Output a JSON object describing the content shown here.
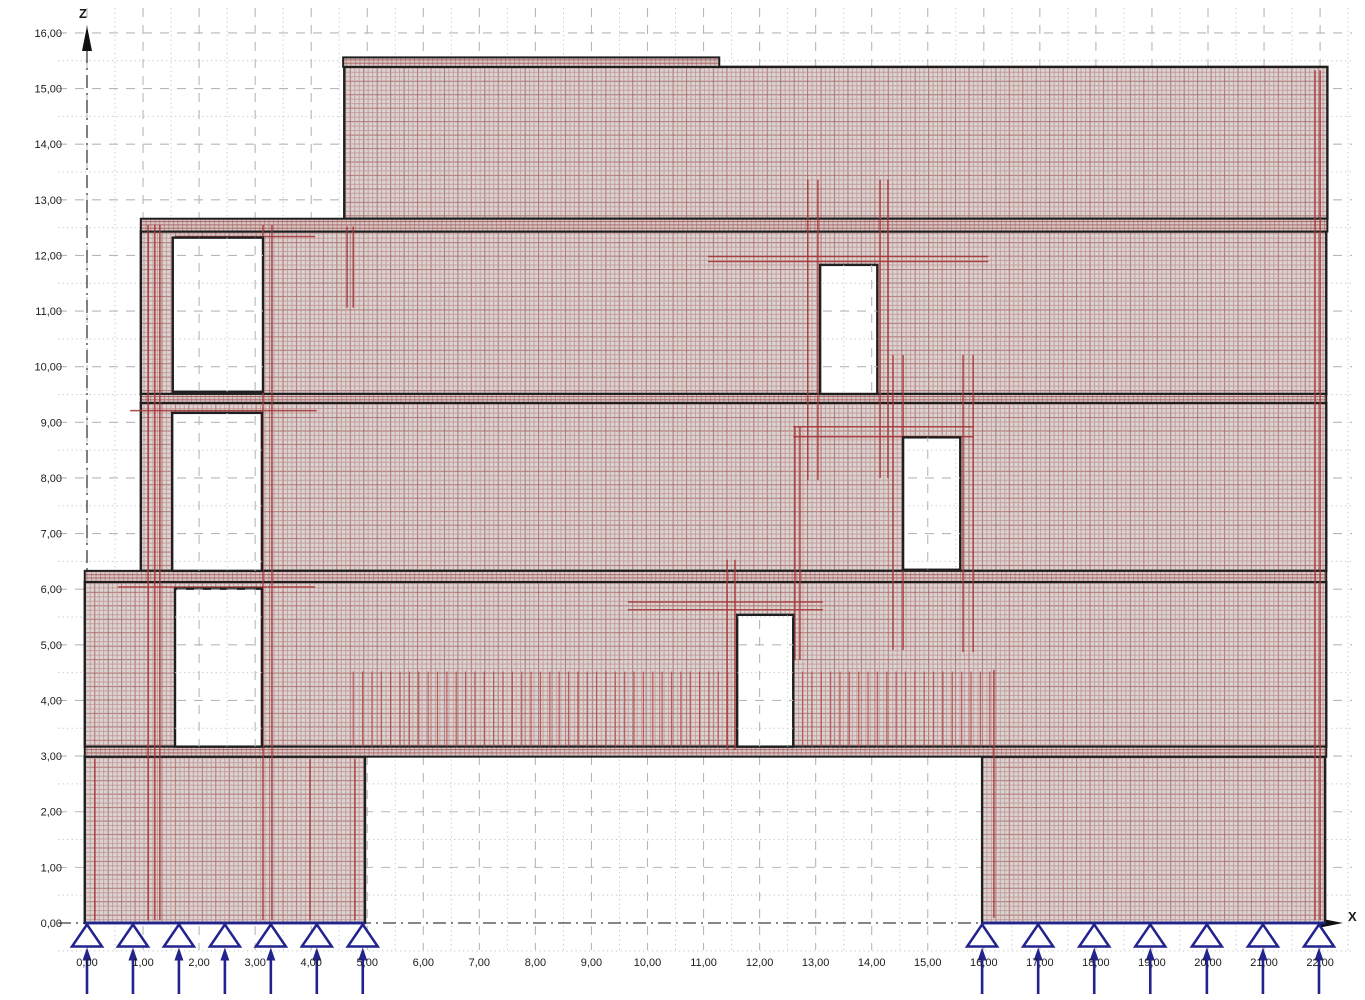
{
  "canvas": {
    "width": 1365,
    "height": 1000,
    "background": "#ffffff"
  },
  "scale": {
    "origin_px": {
      "x": 87,
      "y": 923
    },
    "px_per_m_x": 56.05,
    "px_per_m_y": 55.63
  },
  "axes": {
    "z": {
      "label": "Z",
      "tick_values": [
        16,
        15,
        14,
        13,
        12,
        11,
        10,
        9,
        8,
        7,
        6,
        5,
        4,
        3,
        2,
        1,
        0
      ],
      "tick_labels": [
        "16,00",
        "15,00",
        "14,00",
        "13,00",
        "12,00",
        "11,00",
        "10,00",
        "9,00",
        "8,00",
        "7,00",
        "6,00",
        "5,00",
        "4,00",
        "3,00",
        "2,00",
        "1,00",
        "0,00"
      ]
    },
    "x": {
      "label": "X",
      "tick_values": [
        0,
        1,
        2,
        3,
        4,
        5,
        6,
        7,
        8,
        9,
        10,
        11,
        12,
        13,
        14,
        15,
        16,
        17,
        18,
        19,
        20,
        21,
        22
      ],
      "tick_labels": [
        "0,00",
        "1,00",
        "2,00",
        "3,00",
        "4,00",
        "5,00",
        "6,00",
        "7,00",
        "8,00",
        "9,00",
        "10,00",
        "11,00",
        "12,00",
        "13,00",
        "14,00",
        "15,00",
        "16,00",
        "17,00",
        "18,00",
        "19,00",
        "20,00",
        "21,00",
        "22,00"
      ]
    }
  },
  "grid": {
    "x_major": [
      0,
      1,
      2,
      3,
      4,
      5,
      6,
      7,
      8,
      9,
      10,
      11,
      12,
      13,
      14,
      15,
      16,
      17,
      18,
      19,
      20,
      21,
      22
    ],
    "x_minor": [
      0.5,
      1.5,
      2.5,
      3.5,
      4.5,
      5.5,
      6.5,
      7.5,
      8.5,
      9.5,
      10.5,
      11.5,
      12.5,
      13.5,
      14.5,
      15.5,
      16.5,
      17.5,
      18.5,
      19.5,
      20.5,
      21.5,
      22.5
    ],
    "z_major": [
      1,
      2,
      3,
      4,
      5,
      6,
      7,
      8,
      9,
      10,
      11,
      12,
      13,
      14,
      15,
      16
    ],
    "z_minor": [
      -0.5,
      0.5,
      1.5,
      2.5,
      3.5,
      4.5,
      5.5,
      6.5,
      7.5,
      8.5,
      9.5,
      10.5,
      11.5,
      12.5,
      13.5,
      14.5,
      15.5
    ]
  },
  "colors": {
    "grid_major": "#b7b7b7",
    "grid_minor": "#c8c8c8",
    "axis_line": "#3d3d3d",
    "label_text": "#1a1a1a",
    "outline": "#1f1f1f",
    "wall_base": "#d8d5d3",
    "wall_mesh_light": "#c4908f",
    "wall_mesh_strong": "#ad6a68",
    "slab_base": "#d5c9c7",
    "slab_mesh_v": "#bd8181",
    "slab_mesh_h": "#a85c5c",
    "red_line": "#a63838",
    "comb_line": "#b24444",
    "support": "#23238e",
    "opening_fill": "#ffffff"
  },
  "structure": {
    "walls": [
      {
        "id": "ground-wall-left",
        "x0": -0.04,
        "x1": 4.96,
        "z0": 0.0,
        "z1": 2.99
      },
      {
        "id": "ground-wall-right",
        "x0": 15.97,
        "x1": 22.09,
        "z0": 0.0,
        "z1": 2.99
      },
      {
        "id": "story1-wall",
        "x0": -0.04,
        "x1": 22.11,
        "z0": 3.17,
        "z1": 6.13
      },
      {
        "id": "story2-wall",
        "x0": 0.96,
        "x1": 22.11,
        "z0": 6.33,
        "z1": 9.35
      },
      {
        "id": "story3-wall",
        "x0": 0.96,
        "x1": 22.11,
        "z0": 9.51,
        "z1": 12.43
      },
      {
        "id": "top-wall",
        "x0": 4.59,
        "x1": 22.13,
        "z0": 12.66,
        "z1": 15.39
      }
    ],
    "slabs": [
      {
        "id": "slab-level1",
        "x0": -0.04,
        "x1": 22.11,
        "z0": 2.99,
        "z1": 3.17
      },
      {
        "id": "slab-level2",
        "x0": -0.04,
        "x1": 22.11,
        "z0": 6.13,
        "z1": 6.33
      },
      {
        "id": "slab-level3",
        "x0": 0.96,
        "x1": 22.11,
        "z0": 9.35,
        "z1": 9.51
      },
      {
        "id": "slab-level4",
        "x0": 0.96,
        "x1": 22.13,
        "z0": 12.43,
        "z1": 12.66
      },
      {
        "id": "roof-parapet",
        "x0": 4.57,
        "x1": 11.28,
        "z0": 15.39,
        "z1": 15.56
      }
    ],
    "openings": [
      {
        "id": "opening-upper-left",
        "x0": 1.53,
        "x1": 3.14,
        "z0": 9.55,
        "z1": 12.32
      },
      {
        "id": "opening-mid-left",
        "x0": 1.52,
        "x1": 3.12,
        "z0": 6.33,
        "z1": 9.17
      },
      {
        "id": "opening-lower-left",
        "x0": 1.57,
        "x1": 3.12,
        "z0": 3.17,
        "z1": 6.01
      },
      {
        "id": "opening-lower-mid",
        "x0": 11.6,
        "x1": 12.6,
        "z0": 3.17,
        "z1": 5.54
      },
      {
        "id": "opening-upper-mid",
        "x0": 13.08,
        "x1": 14.1,
        "z0": 9.51,
        "z1": 11.83
      },
      {
        "id": "opening-right-mid",
        "x0": 14.56,
        "x1": 15.58,
        "z0": 6.35,
        "z1": 8.73
      }
    ]
  },
  "red_lines": {
    "segments": [
      {
        "o": "v",
        "x": 1.09,
        "z0": 0.05,
        "z1": 12.55
      },
      {
        "o": "v",
        "x": 1.21,
        "z0": 0.05,
        "z1": 12.55
      },
      {
        "o": "v",
        "x": 1.3,
        "z0": 0.05,
        "z1": 12.55
      },
      {
        "o": "v",
        "x": 3.14,
        "z0": 0.05,
        "z1": 12.55
      },
      {
        "o": "v",
        "x": 3.3,
        "z0": 0.05,
        "z1": 12.55
      },
      {
        "o": "v",
        "x": 4.64,
        "z0": 11.06,
        "z1": 12.52
      },
      {
        "o": "v",
        "x": 4.75,
        "z0": 11.06,
        "z1": 12.52
      },
      {
        "o": "v",
        "x": 0.14,
        "z0": 0.05,
        "z1": 2.95
      },
      {
        "o": "v",
        "x": 3.98,
        "z0": 0.05,
        "z1": 2.95
      },
      {
        "o": "v",
        "x": 4.78,
        "z0": 0.05,
        "z1": 2.95
      },
      {
        "o": "v",
        "x": 12.86,
        "z0": 7.96,
        "z1": 13.36
      },
      {
        "o": "v",
        "x": 13.04,
        "z0": 7.96,
        "z1": 13.36
      },
      {
        "o": "v",
        "x": 14.15,
        "z0": 8.0,
        "z1": 13.36
      },
      {
        "o": "v",
        "x": 14.29,
        "z0": 8.0,
        "z1": 13.36
      },
      {
        "o": "v",
        "x": 14.38,
        "z0": 4.91,
        "z1": 10.21
      },
      {
        "o": "v",
        "x": 14.56,
        "z0": 4.91,
        "z1": 10.21
      },
      {
        "o": "v",
        "x": 15.63,
        "z0": 4.87,
        "z1": 10.21
      },
      {
        "o": "v",
        "x": 15.81,
        "z0": 4.87,
        "z1": 10.21
      },
      {
        "o": "v",
        "x": 11.42,
        "z0": 3.11,
        "z1": 6.53
      },
      {
        "o": "v",
        "x": 11.56,
        "z0": 3.11,
        "z1": 6.53
      },
      {
        "o": "v",
        "x": 12.63,
        "z0": 4.73,
        "z1": 8.92
      },
      {
        "o": "v",
        "x": 12.72,
        "z0": 4.73,
        "z1": 8.92
      },
      {
        "o": "v",
        "x": 21.91,
        "z0": 0.05,
        "z1": 15.33
      },
      {
        "o": "v",
        "x": 22.0,
        "z0": 0.05,
        "z1": 15.33
      },
      {
        "o": "v",
        "x": 16.18,
        "z0": 0.09,
        "z1": 4.55
      },
      {
        "o": "h",
        "z": 11.98,
        "x0": 11.08,
        "x1": 16.08
      },
      {
        "o": "h",
        "z": 11.89,
        "x0": 11.08,
        "x1": 16.08
      },
      {
        "o": "h",
        "z": 8.92,
        "x0": 12.6,
        "x1": 15.81
      },
      {
        "o": "h",
        "z": 8.74,
        "x0": 12.6,
        "x1": 15.81
      },
      {
        "o": "h",
        "z": 5.77,
        "x0": 9.65,
        "x1": 13.13
      },
      {
        "o": "h",
        "z": 5.63,
        "x0": 9.65,
        "x1": 13.13
      },
      {
        "o": "h",
        "z": 9.21,
        "x0": 0.77,
        "x1": 4.1
      },
      {
        "o": "h",
        "z": 6.04,
        "x0": 0.55,
        "x1": 4.07
      },
      {
        "o": "h",
        "z": 12.34,
        "x0": 1.57,
        "x1": 4.07
      }
    ],
    "comb": {
      "x0": 4.75,
      "x1": 16.2,
      "step": 0.167,
      "z0": 3.17,
      "z1": 4.52
    }
  },
  "supports": {
    "left_x": [
      0.0,
      0.82,
      1.64,
      2.46,
      3.28,
      4.1,
      4.92
    ],
    "right_x": [
      15.97,
      16.97,
      17.97,
      18.97,
      19.98,
      20.98,
      21.98
    ],
    "base_lines": [
      {
        "x0": -0.04,
        "x1": 4.96
      },
      {
        "x0": 15.97,
        "x1": 22.09
      }
    ]
  }
}
